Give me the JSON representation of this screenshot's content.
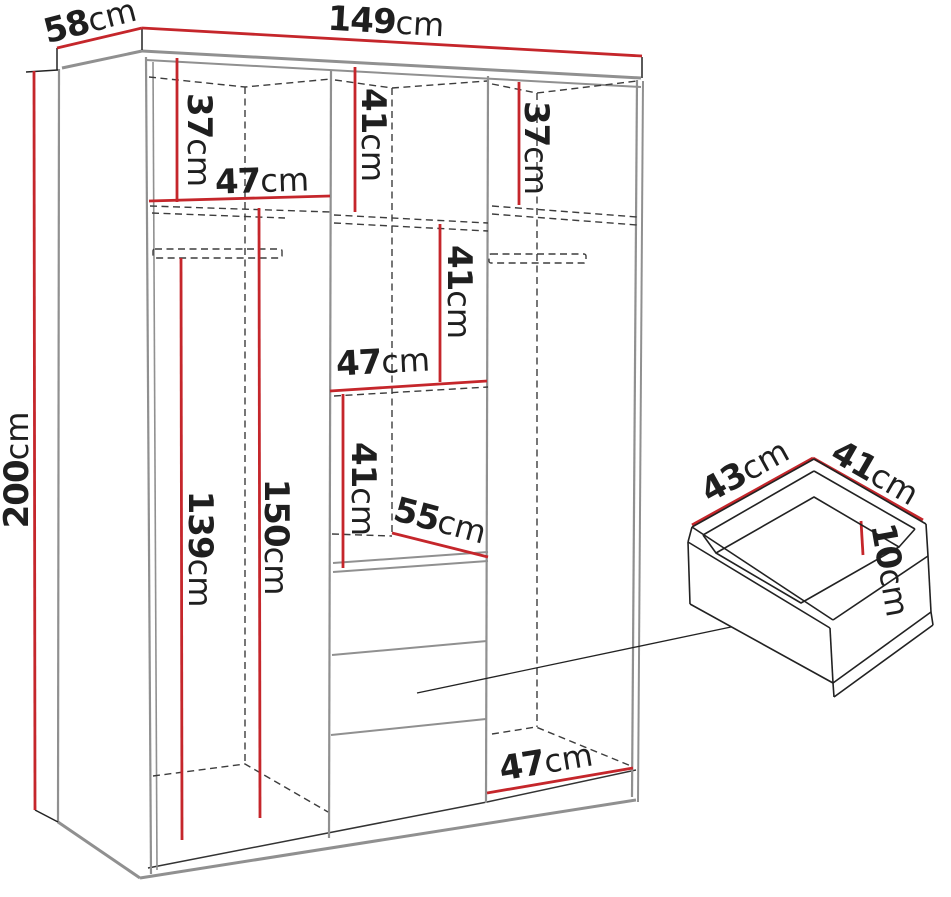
{
  "diagram": {
    "type": "furniture-dimension-diagram",
    "subject": "wardrobe-with-drawer-detail",
    "units": "cm"
  },
  "colors": {
    "dimension_line": "#c5262b",
    "structure": "#909090",
    "hidden": "#3d3d3d",
    "ink": "#1f1f1f",
    "background": "#ffffff"
  },
  "labels": [
    {
      "id": "overall-depth",
      "number": "58",
      "unit": "cm"
    },
    {
      "id": "overall-width",
      "number": "149",
      "unit": "cm"
    },
    {
      "id": "overall-height",
      "number": "200",
      "unit": "cm"
    },
    {
      "id": "left-top-height",
      "number": "37",
      "unit": "cm"
    },
    {
      "id": "left-shelf-width",
      "number": "47",
      "unit": "cm"
    },
    {
      "id": "left-hanging-height",
      "number": "139",
      "unit": "cm"
    },
    {
      "id": "left-inner-height",
      "number": "150",
      "unit": "cm"
    },
    {
      "id": "middle-top-height",
      "number": "41",
      "unit": "cm"
    },
    {
      "id": "middle-upper-height",
      "number": "41",
      "unit": "cm"
    },
    {
      "id": "middle-shelf-width",
      "number": "47",
      "unit": "cm"
    },
    {
      "id": "middle-lower-height",
      "number": "41",
      "unit": "cm"
    },
    {
      "id": "drawer-top-depth",
      "number": "55",
      "unit": "cm"
    },
    {
      "id": "right-top-height",
      "number": "37",
      "unit": "cm"
    },
    {
      "id": "right-bottom-width",
      "number": "47",
      "unit": "cm"
    },
    {
      "id": "detail-drawer-width",
      "number": "43",
      "unit": "cm"
    },
    {
      "id": "detail-drawer-depth",
      "number": "41",
      "unit": "cm"
    },
    {
      "id": "detail-drawer-height",
      "number": "10",
      "unit": "cm"
    }
  ]
}
